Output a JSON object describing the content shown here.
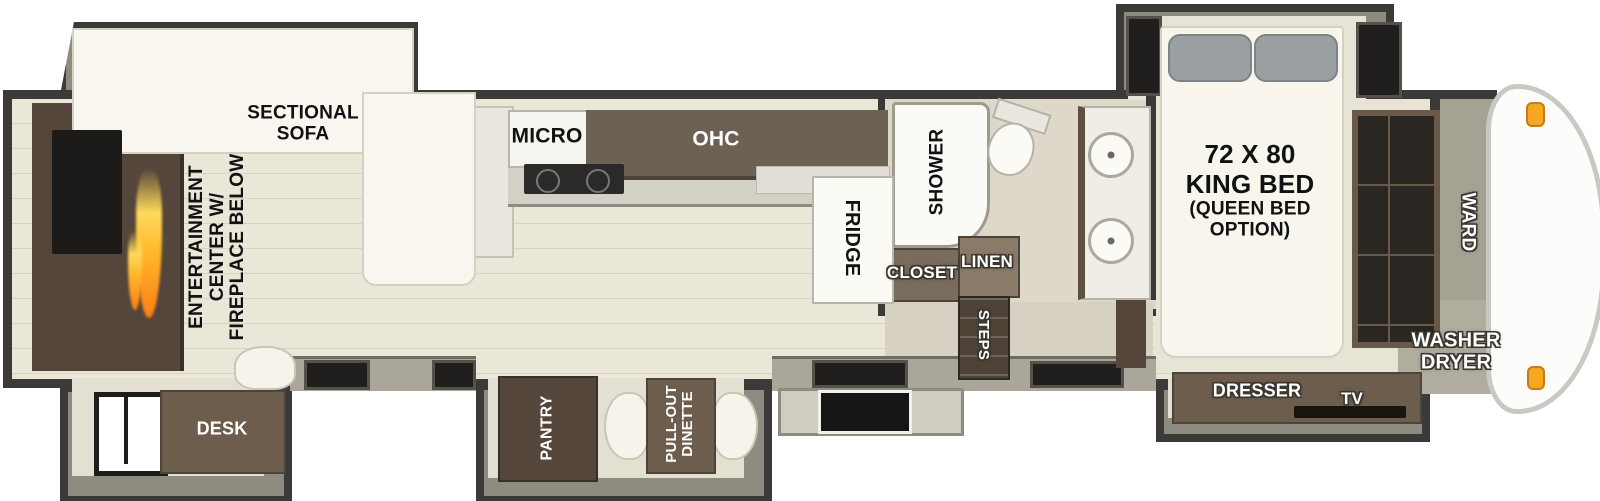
{
  "floorplan": {
    "living_area": {
      "sectional_sofa_label": "SECTIONAL\nSOFA",
      "entertainment_center_label": "ENTERTAINMENT\nCENTER W/\nFIREPLACE BELOW",
      "desk_label": "DESK"
    },
    "kitchen": {
      "micro_label": "MICRO",
      "ohc_label": "OHC",
      "fridge_label": "FRIDGE",
      "pantry_label": "PANTRY",
      "dinette_label": "PULL-OUT\nDINETTE"
    },
    "bathroom": {
      "shower_label": "SHOWER",
      "closet_label": "CLOSET",
      "linen_label": "LINEN",
      "steps_label": "STEPS"
    },
    "bedroom": {
      "bed_label": "72 X 80\nKING BED",
      "bed_option_label": "(QUEEN BED\nOPTION)",
      "dresser_label": "DRESSER",
      "tv_label": "TV",
      "ward_label": "WARD",
      "washer_dryer_label": "WASHER\nDRYER"
    },
    "colors": {
      "wall": "#3b3a38",
      "slide_wall": "#8e8b81",
      "floor": "#eae7d9",
      "floor_alt": "#d9d3c3",
      "cabinet_dark": "#54463a",
      "cabinet_brown": "#6d5d4d",
      "furniture_white": "#f8f6ee",
      "flame_orange": "#ff9d2e",
      "marker_light": "#f5a623"
    }
  }
}
